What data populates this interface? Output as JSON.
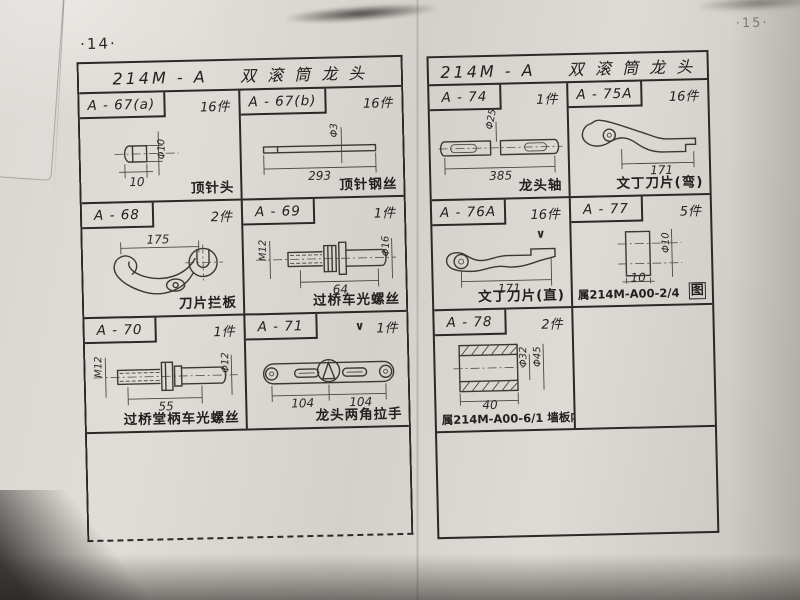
{
  "scan": {
    "left_page_number": "·14·",
    "right_page_number": "·15·"
  },
  "left": {
    "title": "214M - A    双 滚 筒 龙 头",
    "cells": [
      {
        "part_no": "A - 67(a)",
        "qty": "16件",
        "label": "顶针头",
        "dims": [
          "10",
          "Φ10"
        ]
      },
      {
        "part_no": "A - 67(b)",
        "qty": "16件",
        "label": "顶针钢丝",
        "dims": [
          "293",
          "Φ3"
        ]
      },
      {
        "part_no": "A - 68",
        "qty": "2件",
        "label": "刀片拦板",
        "dims": [
          "175"
        ]
      },
      {
        "part_no": "A - 69",
        "qty": "1件",
        "label": "过桥车光螺丝",
        "dims": [
          "M12",
          "64",
          "Φ16"
        ]
      },
      {
        "part_no": "A - 70",
        "qty": "1件",
        "label": "过桥堂柄车光螺丝",
        "dims": [
          "M12",
          "Φ12",
          "55"
        ]
      },
      {
        "part_no": "A - 71",
        "qty": "1件",
        "label": "龙头两角拉手",
        "dims": [
          "104",
          "104"
        ]
      },
      {
        "part_no": "A - 72",
        "qty": "2件",
        "label": "滚筒长唐司",
        "dims": [
          "Φ14",
          "54"
        ]
      },
      {
        "part_no": "A - 73",
        "qty": "2件",
        "label": "滚筒短唐司",
        "dims": [
          "Φ14",
          "44"
        ]
      }
    ]
  },
  "right": {
    "title": "214M - A    双 滚 筒 龙 头",
    "cells": [
      {
        "part_no": "A - 74",
        "qty": "1件",
        "label": "龙头轴",
        "dims": [
          "Φ25",
          "385"
        ]
      },
      {
        "part_no": "A - 75A",
        "qty": "16件",
        "label": "文丁刀片(弯)",
        "dims": [
          "171"
        ]
      },
      {
        "part_no": "A - 76A",
        "qty": "16件",
        "label": "文丁刀片(直)",
        "dims": [
          "171"
        ]
      },
      {
        "part_no": "A - 77",
        "qty": "5件",
        "label": "属214M-A00-2/4",
        "label_right": "图",
        "dims": [
          "10",
          "Φ10"
        ]
      },
      {
        "part_no": "A - 78",
        "qty": "2件",
        "label": "属214M-A00-6/1 墙板内套筒",
        "dims": [
          "Φ32",
          "Φ45",
          "40"
        ]
      }
    ]
  },
  "annotations": {
    "checkmark": "∨"
  }
}
